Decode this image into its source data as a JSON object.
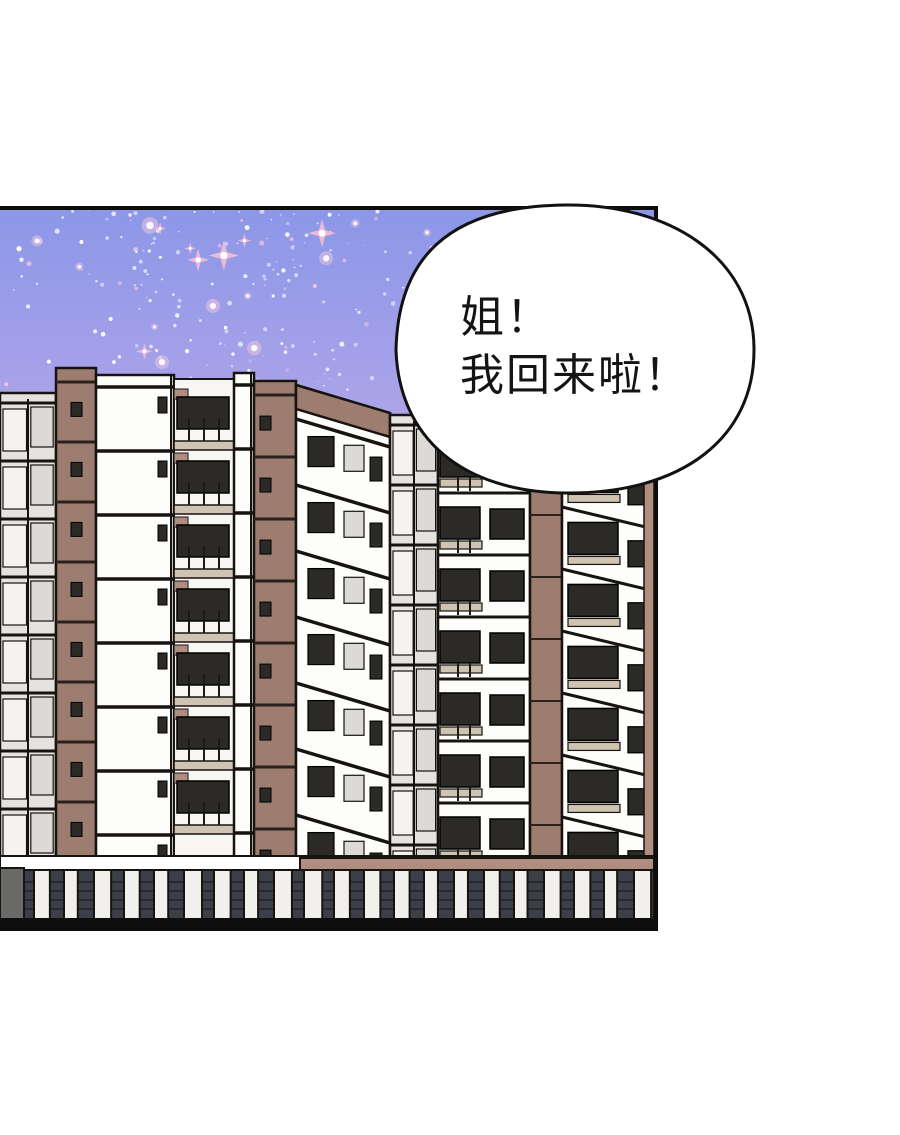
{
  "page": {
    "background": "#ffffff"
  },
  "panel": {
    "border_color": "#0f0d0b"
  },
  "sky": {
    "top": "#8c97e8",
    "upper_mid": "#a8a2e9",
    "lower_mid": "#c2b1e7",
    "horizon": "#e8cfe9",
    "star_white": "#ffffff",
    "star_pink_soft": "#f4c8dd",
    "sparkle_pink": "#f0bcd6"
  },
  "buildings": {
    "wall_white": "#fdfdfc",
    "wall_gray": "#e4e3df",
    "pane_light": "#f4f3f1",
    "pane_gray": "#dbdad6",
    "brown": "#9c7d70",
    "brown_light": "#b08d7e",
    "ledge": "#cfc4b1",
    "window_dark": "#2b2a26",
    "outline": "#17130f",
    "ground_dark": "#3c3f48",
    "ground_slat": "#262a33"
  },
  "speech_bubble": {
    "fill": "#ffffff",
    "stroke": "#121212",
    "text_color": "#141414",
    "lines": [
      "姐！",
      "我回来啦！"
    ]
  }
}
